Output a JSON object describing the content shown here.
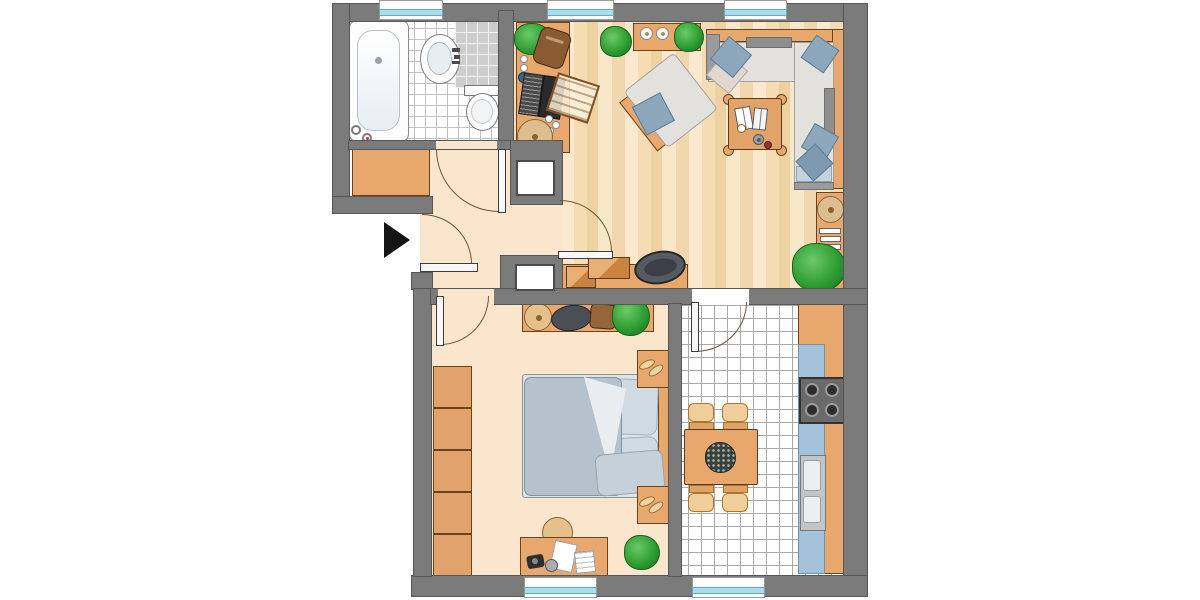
{
  "document": {
    "kind": "apartment-floor-plan",
    "style": "top-down color illustration, no text labels",
    "canvas": {
      "width": 1200,
      "height": 600,
      "background": "#ffffff"
    }
  },
  "colors": {
    "wall": "#7b7b7b",
    "wall_outline": "#565656",
    "floor_hall": "#fae5cd",
    "furniture": "#e8a76d",
    "furniture_outline": "#6b431d",
    "sofa_seat": "#e3e1dd",
    "cushion_blue": "#8ca6bc",
    "bed_duvet": "#b5c2cc",
    "bed_pillow": "#cfdae2",
    "counter_blue": "#a4c3db",
    "window_glass": "#aadeee",
    "plant_green": "#2f9e33",
    "arrow": "#141414"
  },
  "rooms": [
    {
      "id": "bathroom",
      "position": "top-left",
      "floor": "white-tiles",
      "furniture": [
        "bathtub",
        "washbasin",
        "shower-area",
        "toilet"
      ]
    },
    {
      "id": "living-room",
      "position": "top-right",
      "floor": "wood-planks",
      "furniture": [
        "desk-with-laptop",
        "desk-chair",
        "sideboard-with-bowls",
        "corner-sofa",
        "sofa-pillows",
        "armchair",
        "coffee-table-with-books",
        "wall-shelf-with-basket-and-books",
        "storage-bench-with-boxes",
        "plants"
      ]
    },
    {
      "id": "hallway",
      "position": "center-left",
      "floor": "peach",
      "furniture": [
        "cabinet"
      ],
      "features": [
        "entrance-door",
        "two-duct-shafts"
      ]
    },
    {
      "id": "bedroom",
      "position": "bottom-left",
      "floor": "peach",
      "furniture": [
        "wardrobe-5-sections",
        "double-bed",
        "nightstand-with-slippers-top",
        "nightstand-with-slippers-bottom",
        "wall-shelf-with-hat-and-bag",
        "desk-with-papers",
        "desk-chair",
        "plant"
      ]
    },
    {
      "id": "kitchen",
      "position": "bottom-right",
      "floor": "white-tiles",
      "furniture": [
        "kitchen-counter",
        "stove-4-burners",
        "double-sink",
        "dining-table",
        "four-chairs",
        "plant-centerpiece"
      ]
    }
  ],
  "openings": {
    "windows_top_wall": 3,
    "windows_bottom_wall": 2,
    "doors": [
      "entrance",
      "bathroom",
      "living-room",
      "bedroom",
      "kitchen"
    ],
    "entrance_marker": "black-triangle-arrow-pointing-right"
  }
}
